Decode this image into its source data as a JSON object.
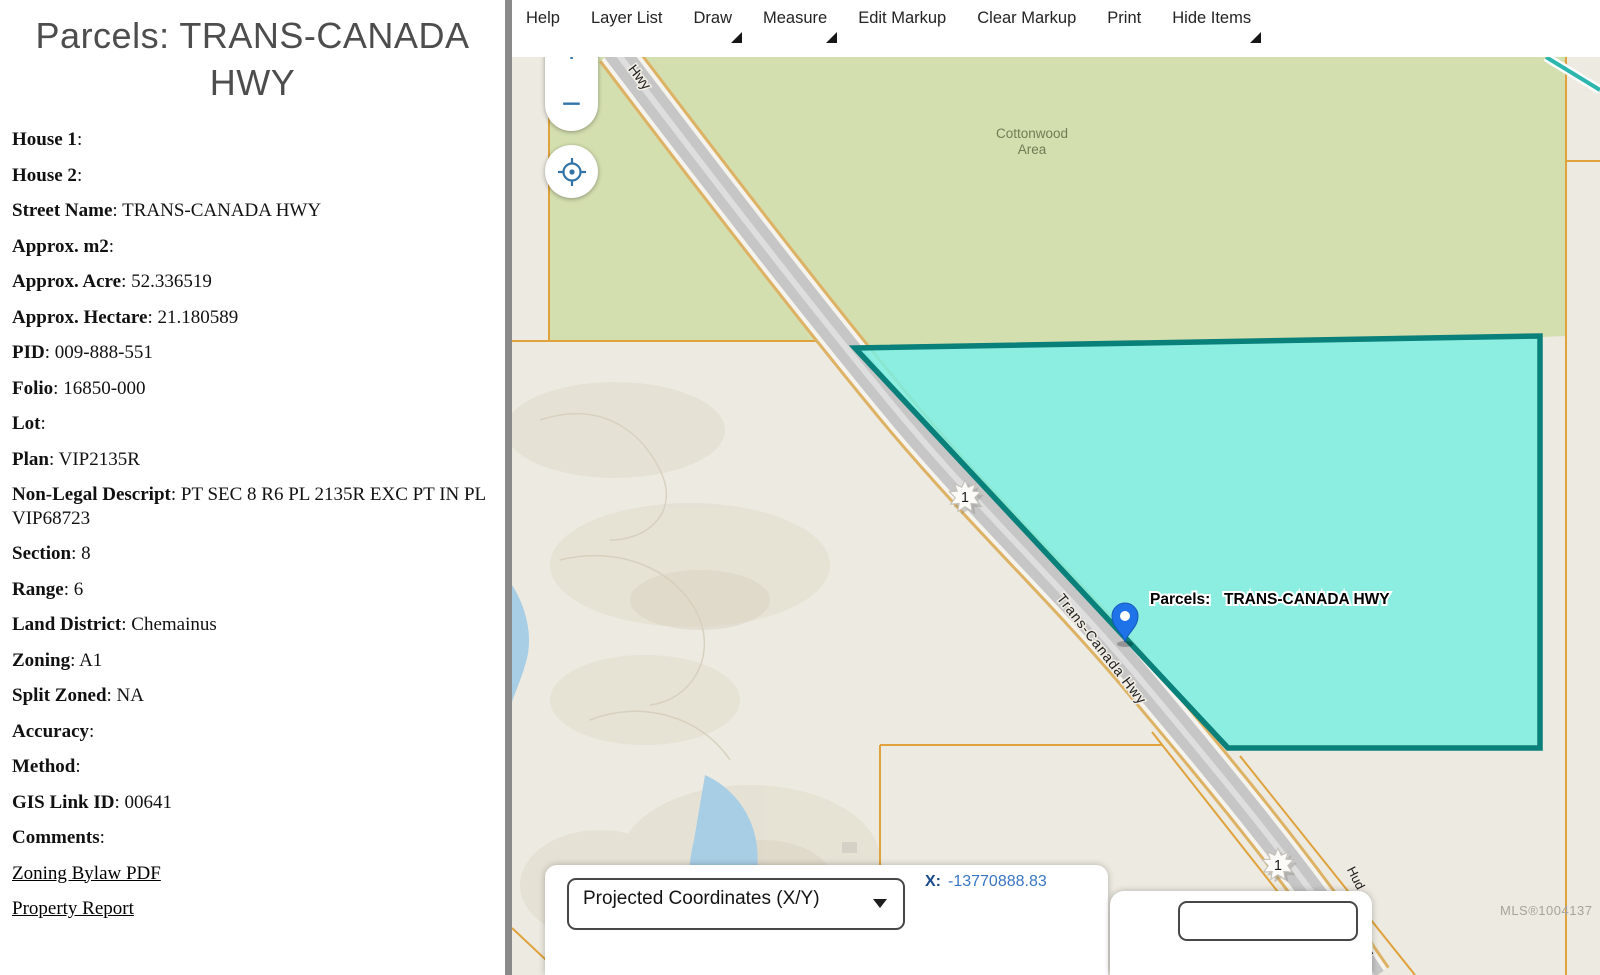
{
  "left_panel": {
    "title": "Parcels: TRANS-CANADA HWY",
    "fields": [
      {
        "label": "House 1",
        "value": ""
      },
      {
        "label": "House 2",
        "value": ""
      },
      {
        "label": "Street Name",
        "value": "TRANS-CANADA HWY"
      },
      {
        "label": "Approx. m2",
        "value": ""
      },
      {
        "label": "Approx. Acre",
        "value": "52.336519"
      },
      {
        "label": "Approx. Hectare",
        "value": "21.180589"
      },
      {
        "label": "PID",
        "value": "009-888-551"
      },
      {
        "label": "Folio",
        "value": "16850-000"
      },
      {
        "label": "Lot",
        "value": ""
      },
      {
        "label": "Plan",
        "value": "VIP2135R"
      },
      {
        "label": "Non-Legal Descript",
        "value": "PT SEC 8 R6 PL 2135R EXC PT IN PL VIP68723"
      },
      {
        "label": "Section",
        "value": "8"
      },
      {
        "label": "Range",
        "value": "6"
      },
      {
        "label": "Land District",
        "value": "Chemainus"
      },
      {
        "label": "Zoning",
        "value": "A1"
      },
      {
        "label": "Split Zoned",
        "value": "NA"
      },
      {
        "label": "Accuracy",
        "value": ""
      },
      {
        "label": "Method",
        "value": ""
      },
      {
        "label": "GIS Link ID",
        "value": "00641"
      },
      {
        "label": "Comments",
        "value": ""
      }
    ],
    "links": [
      "Zoning Bylaw PDF",
      "Property Report"
    ]
  },
  "toolbar": {
    "items": [
      {
        "label": "Help",
        "dropdown": false
      },
      {
        "label": "Layer List",
        "dropdown": false
      },
      {
        "label": "Draw",
        "dropdown": true
      },
      {
        "label": "Measure",
        "dropdown": true
      },
      {
        "label": "Edit Markup",
        "dropdown": false
      },
      {
        "label": "Clear Markup",
        "dropdown": false
      },
      {
        "label": "Print",
        "dropdown": false
      },
      {
        "label": "Hide Items",
        "dropdown": true
      }
    ]
  },
  "map": {
    "controls": {
      "zoom_in": "+",
      "zoom_out": "−"
    },
    "labels": {
      "area_line1": "Cottonwood",
      "area_line2": "Area",
      "road_top": "Hwy",
      "road_main": "Trans-Canada Hwy",
      "road_bottom_1": "Hud",
      "road_bottom_2": "Hwy",
      "parcel_label": "Parcels:",
      "parcel_name": "TRANS-CANADA HWY",
      "route_shield": "1",
      "watermark": "MLS®1004137"
    },
    "colors": {
      "parcel_fill": "#7DEEE0",
      "parcel_border": "#098079",
      "cadastral_line": "#DFA23C",
      "area_green": "#D4DFAF",
      "land_beige": "#EDEAE1",
      "water_blue": "#A8CEE5",
      "control_blue": "#3273A8",
      "pin_blue": "#1E73E8"
    }
  },
  "statusbar": {
    "selector": "Projected Coordinates (X/Y)",
    "x_label": "X:",
    "x_value": "-13770888.83"
  }
}
